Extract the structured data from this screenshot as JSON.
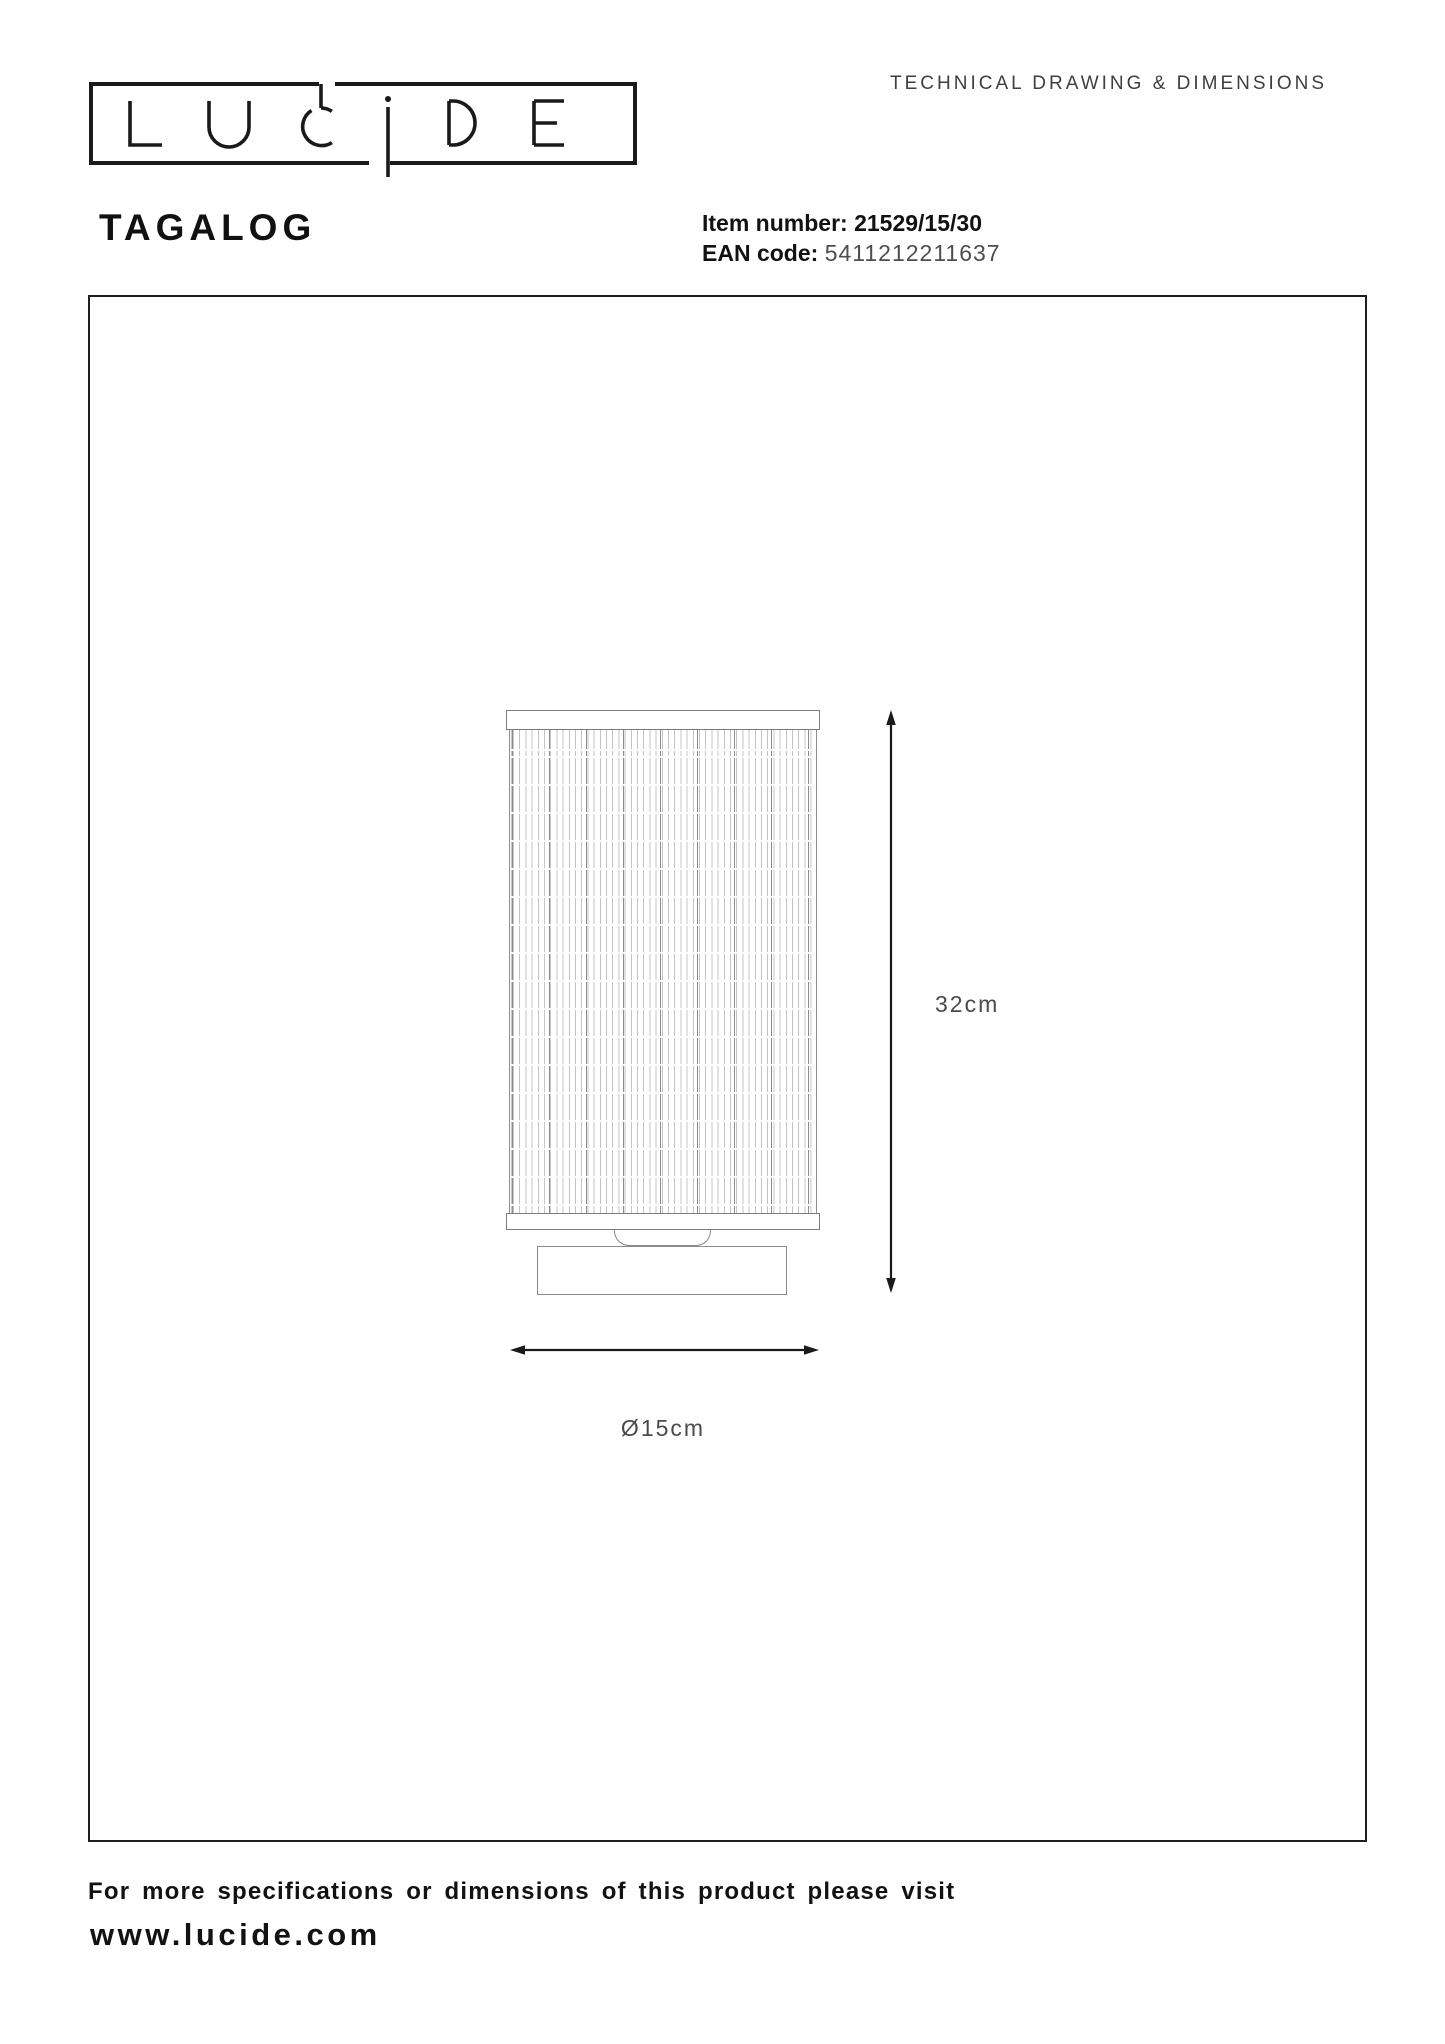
{
  "header": {
    "page_label": "TECHNICAL DRAWING & DIMENSIONS",
    "logo_text": "LUCIDE"
  },
  "product": {
    "name": "TAGALOG",
    "item_number_label": "Item number:",
    "item_number_value": "21529/15/30",
    "ean_label": "EAN code:",
    "ean_value": "5411212211637"
  },
  "drawing": {
    "height_label": "32cm",
    "diameter_label": "Ø15cm",
    "outline_color": "#8a8a8a",
    "dimension_line_color": "#1a1a1a",
    "panel_border_color": "#1f1f1f"
  },
  "footer": {
    "note": "For more specifications or dimensions of this product please visit",
    "website": "www.lucide.com"
  }
}
